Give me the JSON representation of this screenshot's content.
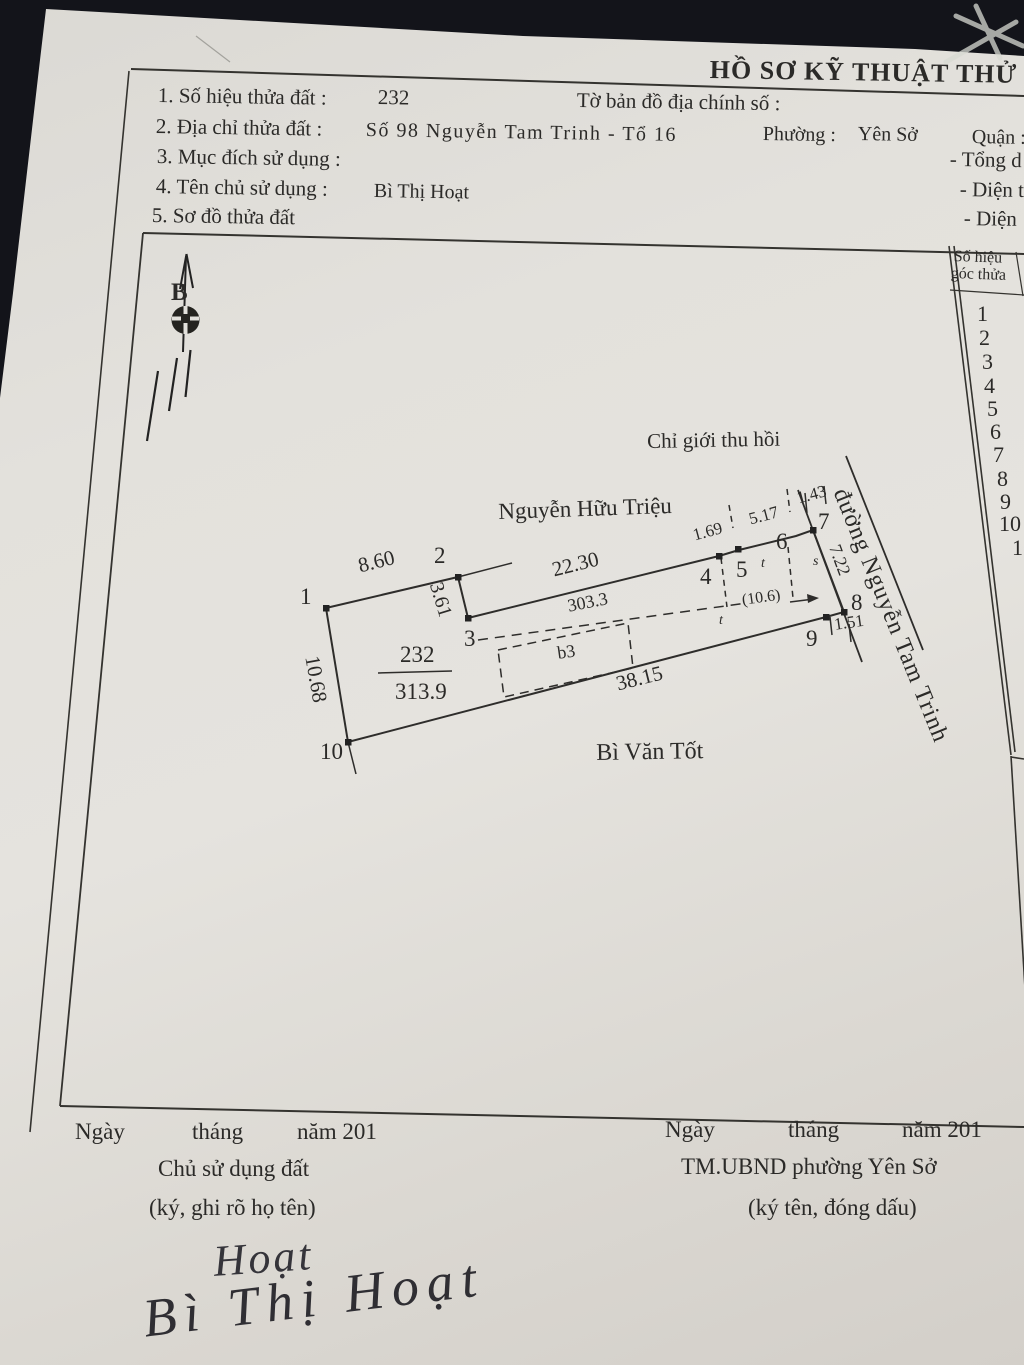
{
  "document": {
    "title": "HỒ SƠ KỸ THUẬT THỬ",
    "fields": [
      {
        "label": "1. Số hiệu thửa đất :",
        "value": "232",
        "extra": "Tờ bản đồ địa chính số :"
      },
      {
        "label": "2. Địa chỉ thửa đất :",
        "value": "Số 98 Nguyễn Tam Trinh - Tổ 16",
        "extra": "Phường :",
        "extra2": "Yên Sở",
        "right": "Quận :"
      },
      {
        "label": "3. Mục đích sử dụng :",
        "right": "- Tổng d"
      },
      {
        "label": "4. Tên chủ sử dụng :",
        "value": "Bì Thị Hoạt",
        "right": "- Diện t"
      },
      {
        "label": "5. Sơ đồ thửa đất",
        "right": "- Diện"
      }
    ]
  },
  "corner_table": {
    "header_line1": "Số hiệu",
    "header_line2": "góc thửa",
    "rows": [
      [
        "1",
        977,
        303
      ],
      [
        "2",
        979,
        327
      ],
      [
        "3",
        982,
        351
      ],
      [
        "4",
        984,
        375
      ],
      [
        "5",
        987,
        398
      ],
      [
        "6",
        990,
        421
      ],
      [
        "7",
        993,
        444
      ],
      [
        "8",
        997,
        468
      ],
      [
        "9",
        1000,
        491
      ],
      [
        "10",
        999,
        513
      ],
      [
        "1",
        1012,
        537
      ]
    ]
  },
  "parcel": {
    "number": "232",
    "area": "313.9",
    "north_label": "B",
    "edge_lengths": [
      "8.60",
      "3.61",
      "22.30",
      "1.69",
      "5.17",
      "1.43",
      "7.22",
      "1.51",
      "38.15",
      "10.68"
    ],
    "recovery_boundary": "Chỉ giới thu hồi",
    "adjacent_top": "Nguyễn Hữu Triệu",
    "adjacent_bottom": "Bì Văn Tốt",
    "road": "đường Nguyễn Tam Trinh",
    "annotations": [
      "303.3",
      "b3",
      "(10.6)",
      "s",
      "t"
    ]
  },
  "diagram": {
    "labels": [
      {
        "n": "point-1-label",
        "t": "1",
        "x": 300,
        "y": 585,
        "s": 23
      },
      {
        "n": "point-2-label",
        "t": "2",
        "x": 434,
        "y": 544,
        "s": 23
      },
      {
        "n": "point-3-label",
        "t": "3",
        "x": 464,
        "y": 627,
        "s": 23
      },
      {
        "n": "point-4-label",
        "t": "4",
        "x": 700,
        "y": 565,
        "s": 23
      },
      {
        "n": "point-5-label",
        "t": "5",
        "x": 736,
        "y": 558,
        "s": 23
      },
      {
        "n": "point-6-label",
        "t": "6",
        "x": 776,
        "y": 530,
        "s": 23
      },
      {
        "n": "point-7-label",
        "t": "7",
        "x": 818,
        "y": 510,
        "s": 23
      },
      {
        "n": "point-8-label",
        "t": "8",
        "x": 851,
        "y": 591,
        "s": 23
      },
      {
        "n": "point-9-label",
        "t": "9",
        "x": 806,
        "y": 627,
        "s": 23
      },
      {
        "n": "point-10-label",
        "t": "10",
        "x": 320,
        "y": 740,
        "s": 23
      },
      {
        "n": "dim-8-60",
        "t": "8.60",
        "x": 356,
        "y": 556,
        "s": 21,
        "r": -14
      },
      {
        "n": "dim-3-61",
        "t": "3.61",
        "x": 445,
        "y": 580,
        "s": 20,
        "r": 73
      },
      {
        "n": "dim-22-30",
        "t": "22.30",
        "x": 550,
        "y": 560,
        "s": 21,
        "r": -14
      },
      {
        "n": "dim-1-69",
        "t": "1.69",
        "x": 691,
        "y": 527,
        "s": 17,
        "r": -15
      },
      {
        "n": "dim-5-17",
        "t": "5.17",
        "x": 747,
        "y": 511,
        "s": 17,
        "r": -15
      },
      {
        "n": "dim-1-43",
        "t": "1.43",
        "x": 795,
        "y": 490,
        "s": 17,
        "r": -15
      },
      {
        "n": "dim-7-22",
        "t": "7.22",
        "x": 843,
        "y": 542,
        "s": 18,
        "r": 70
      },
      {
        "n": "dim-1-51",
        "t": "1.51",
        "x": 833,
        "y": 616,
        "s": 17,
        "r": -8
      },
      {
        "n": "dim-38-15",
        "t": "38.15",
        "x": 614,
        "y": 674,
        "s": 21,
        "r": -14
      },
      {
        "n": "dim-10-68",
        "t": "10.68",
        "x": 322,
        "y": 654,
        "s": 21,
        "r": 80
      },
      {
        "n": "parcel-number",
        "t": "232",
        "x": 400,
        "y": 643,
        "s": 23
      },
      {
        "n": "parcel-area",
        "t": "313.9",
        "x": 395,
        "y": 680,
        "s": 23
      },
      {
        "n": "dim-303-3",
        "t": "303.3",
        "x": 566,
        "y": 597,
        "s": 18,
        "r": -11
      },
      {
        "n": "label-b3",
        "t": "b3",
        "x": 556,
        "y": 644,
        "s": 18,
        "r": -8
      },
      {
        "n": "dim-10-6",
        "t": "(10.6)",
        "x": 741,
        "y": 593,
        "s": 16,
        "r": -8
      },
      {
        "n": "label-s",
        "t": "s",
        "x": 813,
        "y": 555,
        "s": 14,
        "i": 1
      },
      {
        "n": "label-t-upper",
        "t": "t",
        "x": 761,
        "y": 557,
        "s": 14,
        "i": 1
      },
      {
        "n": "label-t-lower",
        "t": "t",
        "x": 719,
        "y": 614,
        "s": 14,
        "i": 1
      },
      {
        "n": "road-name",
        "t": "đường Nguyễn Tam Trinh",
        "x": 851,
        "y": 485,
        "s": 24,
        "r": 68,
        "ls": 1
      },
      {
        "n": "adjacent-owner-top",
        "t": "Nguyễn Hữu Triệu",
        "x": 498,
        "y": 500,
        "s": 23,
        "r": -2
      },
      {
        "n": "recovery-boundary-label",
        "t": "Chỉ giới thu hồi",
        "x": 647,
        "y": 431,
        "s": 21,
        "r": -1
      },
      {
        "n": "adjacent-owner-bottom",
        "t": "Bì Văn Tốt",
        "x": 596,
        "y": 741,
        "s": 24,
        "r": -1
      },
      {
        "n": "north-label",
        "t": "B",
        "x": 171,
        "y": 280,
        "s": 25,
        "w": 700
      }
    ]
  },
  "footer": {
    "left": {
      "date_words": [
        "Ngày",
        "tháng",
        "năm 201"
      ],
      "role": "Chủ sử dụng đất",
      "note": "(ký, ghi rõ họ tên)"
    },
    "right": {
      "date_words": [
        "Ngày",
        "tháng",
        "năm 201"
      ],
      "role": "TM.UBND phường Yên Sở",
      "note": "(ký tên, đóng dấu)"
    }
  },
  "signatures": {
    "sign": "Hoạt",
    "name": "Bì Thị Hoạt"
  }
}
